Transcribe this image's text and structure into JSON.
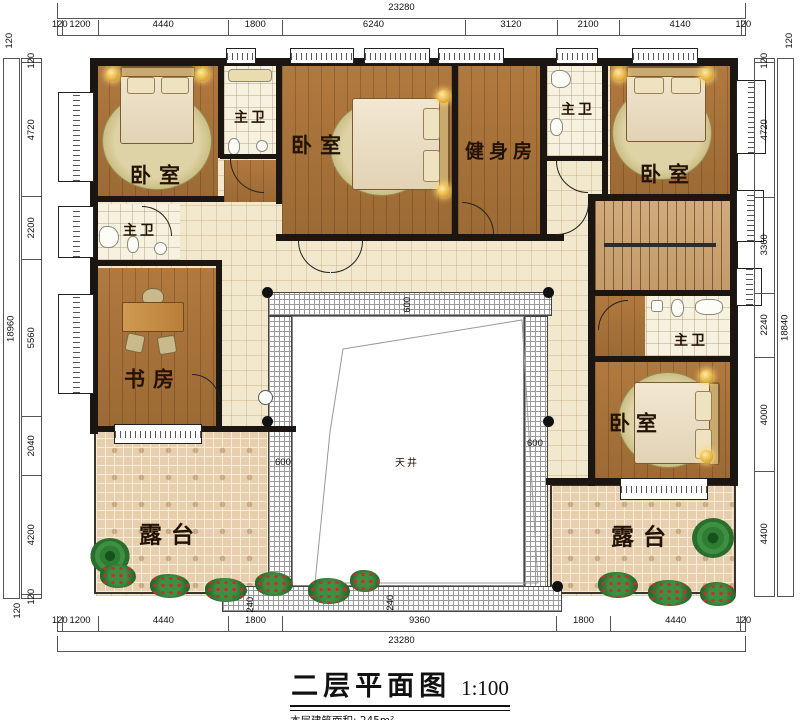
{
  "labels": {
    "bedroom": "卧室",
    "master_bath": "主卫",
    "gym": "健身房",
    "study": "书房",
    "terrace": "露台",
    "courtyard": "天井"
  },
  "title": {
    "name": "二层平面图",
    "scale": "1:100",
    "area_note": "本层建筑面积: 245m²"
  },
  "dims": {
    "top": {
      "total": "23280",
      "segments": [
        "120",
        "1200",
        "4440",
        "1800",
        "6240",
        "3120",
        "2100",
        "4140",
        "120"
      ],
      "corner_left": "120",
      "corner_right": "120"
    },
    "bottom": {
      "total": "23280",
      "segments": [
        "120",
        "1200",
        "4440",
        "1800",
        "9360",
        "1800",
        "4440",
        "120"
      ],
      "corner_left": "120"
    },
    "left": {
      "total": "18960",
      "segments": [
        "120",
        "4720",
        "2200",
        "5560",
        "2040",
        "4200",
        "120"
      ]
    },
    "right": {
      "total": "18840",
      "segments": [
        "120",
        "4720",
        "3360",
        "2240",
        "4000",
        "4400"
      ]
    },
    "inner": {
      "court_top": "600",
      "court_left": "600",
      "court_right": "600",
      "walk_a": "240",
      "walk_b": "240"
    }
  },
  "colors": {
    "wall": "#1b1611",
    "wood": "#a9743f",
    "hall": "#f2e8cd",
    "bath": "#f7f1e0",
    "terrace": "#e7cfae",
    "court_band": "#ffffff",
    "plant_green": "#2e7d32",
    "flower_red": "#c4302b"
  }
}
